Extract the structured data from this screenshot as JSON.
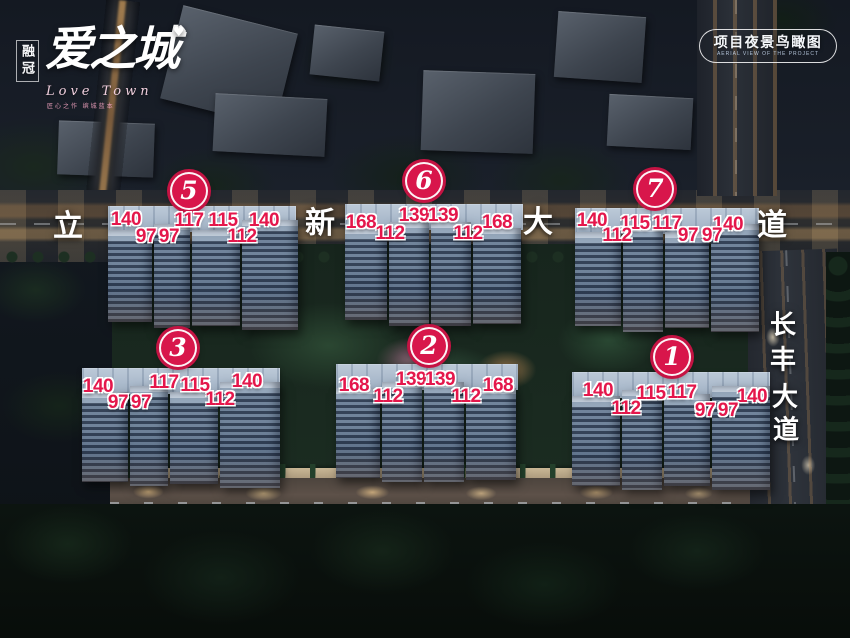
{
  "logo": {
    "brand": "融冠",
    "name": "爱之城",
    "heart": "♥",
    "english": "Love Town",
    "tagline": "匠心之作 缤城蓝本"
  },
  "view_badge": {
    "title": "项目夜景鸟瞰图",
    "subtitle": "AERIAL VIEW OF THE PROJECT"
  },
  "roads": {
    "top_road_name": "立新大道",
    "right_road_name": "长丰大道"
  },
  "road_labels": [
    {
      "ch": "立",
      "x": 68,
      "y": 223,
      "fs": 30
    },
    {
      "ch": "新",
      "x": 320,
      "y": 220,
      "fs": 30
    },
    {
      "ch": "大",
      "x": 538,
      "y": 219,
      "fs": 30
    },
    {
      "ch": "道",
      "x": 772,
      "y": 222,
      "fs": 30
    },
    {
      "ch": "长",
      "x": 783,
      "y": 323,
      "fs": 26
    },
    {
      "ch": "丰",
      "x": 783,
      "y": 358,
      "fs": 26
    },
    {
      "ch": "大",
      "x": 785,
      "y": 395,
      "fs": 26
    },
    {
      "ch": "道",
      "x": 786,
      "y": 428,
      "fs": 26
    }
  ],
  "clusters": [
    {
      "no": "5",
      "x": 189,
      "y": 191,
      "areas": [
        {
          "v": "140",
          "x": 126,
          "y": 220
        },
        {
          "v": "117",
          "x": 189,
          "y": 221
        },
        {
          "v": "115",
          "x": 223,
          "y": 221
        },
        {
          "v": "140",
          "x": 264,
          "y": 221
        },
        {
          "v": "97",
          "x": 146,
          "y": 237
        },
        {
          "v": "97",
          "x": 169,
          "y": 237
        },
        {
          "v": "112",
          "x": 242,
          "y": 237
        }
      ]
    },
    {
      "no": "6",
      "x": 424,
      "y": 181,
      "areas": [
        {
          "v": "168",
          "x": 361,
          "y": 223
        },
        {
          "v": "139",
          "x": 414,
          "y": 216
        },
        {
          "v": "139",
          "x": 443,
          "y": 216
        },
        {
          "v": "168",
          "x": 497,
          "y": 223
        },
        {
          "v": "112",
          "x": 390,
          "y": 234
        },
        {
          "v": "112",
          "x": 468,
          "y": 234
        }
      ]
    },
    {
      "no": "7",
      "x": 655,
      "y": 189,
      "areas": [
        {
          "v": "140",
          "x": 592,
          "y": 221
        },
        {
          "v": "115",
          "x": 635,
          "y": 224
        },
        {
          "v": "117",
          "x": 667,
          "y": 224
        },
        {
          "v": "140",
          "x": 728,
          "y": 225
        },
        {
          "v": "112",
          "x": 617,
          "y": 236
        },
        {
          "v": "97",
          "x": 688,
          "y": 236
        },
        {
          "v": "97",
          "x": 712,
          "y": 236
        }
      ]
    },
    {
      "no": "3",
      "x": 178,
      "y": 348,
      "areas": [
        {
          "v": "140",
          "x": 98,
          "y": 387
        },
        {
          "v": "117",
          "x": 164,
          "y": 383
        },
        {
          "v": "115",
          "x": 195,
          "y": 386
        },
        {
          "v": "140",
          "x": 247,
          "y": 382
        },
        {
          "v": "97",
          "x": 118,
          "y": 403
        },
        {
          "v": "97",
          "x": 141,
          "y": 403
        },
        {
          "v": "112",
          "x": 220,
          "y": 400
        }
      ]
    },
    {
      "no": "2",
      "x": 429,
      "y": 346,
      "areas": [
        {
          "v": "168",
          "x": 354,
          "y": 386
        },
        {
          "v": "139",
          "x": 411,
          "y": 380
        },
        {
          "v": "139",
          "x": 440,
          "y": 380
        },
        {
          "v": "168",
          "x": 498,
          "y": 386
        },
        {
          "v": "112",
          "x": 388,
          "y": 397
        },
        {
          "v": "112",
          "x": 466,
          "y": 397
        }
      ]
    },
    {
      "no": "1",
      "x": 672,
      "y": 357,
      "areas": [
        {
          "v": "140",
          "x": 598,
          "y": 391
        },
        {
          "v": "115",
          "x": 651,
          "y": 394
        },
        {
          "v": "117",
          "x": 682,
          "y": 393
        },
        {
          "v": "140",
          "x": 752,
          "y": 397
        },
        {
          "v": "112",
          "x": 626,
          "y": 409
        },
        {
          "v": "97",
          "x": 705,
          "y": 411
        },
        {
          "v": "97",
          "x": 728,
          "y": 411
        }
      ]
    }
  ],
  "colors": {
    "accent": "#d8164b",
    "label_red": "#e4174b"
  }
}
